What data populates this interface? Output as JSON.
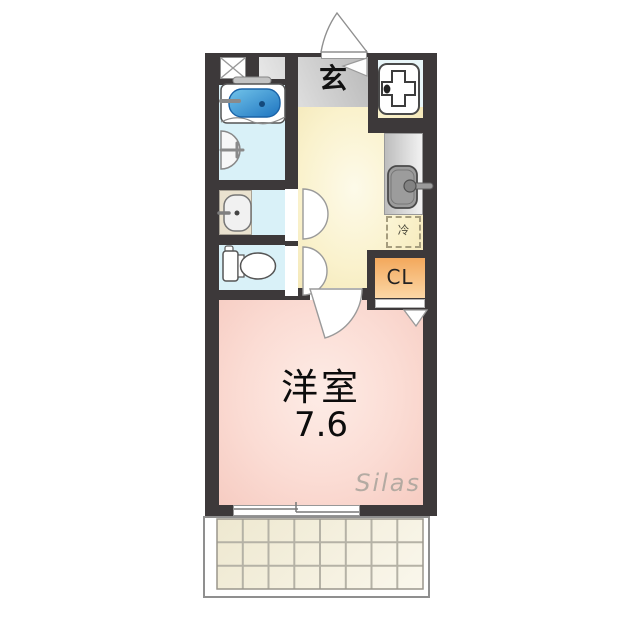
{
  "title": "apartment floor plan (1K unit)",
  "labels": {
    "entrance": "玄",
    "refrigerator": "冷",
    "closet": "CL",
    "room": "洋室",
    "room_size": "7.6",
    "watermark": "Silas"
  },
  "rooms": [
    {
      "name": "entrance-genkan",
      "label": "玄",
      "floor": "gray"
    },
    {
      "name": "bathroom",
      "fixtures": [
        "bathtub",
        "wall-washbasin"
      ],
      "floor": "light-blue"
    },
    {
      "name": "washroom",
      "fixtures": [
        "vanity-washbasin"
      ],
      "floor": "light-blue"
    },
    {
      "name": "toilet-room",
      "fixtures": [
        "toilet"
      ],
      "floor": "light-blue"
    },
    {
      "name": "kitchen-hallway",
      "fixtures": [
        "kitchen-counter-sink",
        "refrigerator-space",
        "washing-machine-pan"
      ],
      "floor": "pale-yellow"
    },
    {
      "name": "western-room",
      "label": "洋室",
      "size_tatami": "7.6",
      "floor": "pink"
    },
    {
      "name": "closet",
      "label": "CL"
    },
    {
      "name": "balcony",
      "grid_cols": 8,
      "grid_rows": 3
    },
    {
      "name": "pipe-space",
      "symbol": "crossed-box"
    }
  ],
  "doors": [
    "entrance-swing-door",
    "washroom-door",
    "toilet-door",
    "room-swing-door",
    "closet-door",
    "sliding-window-to-balcony"
  ],
  "colors": {
    "wall": "#3d393a",
    "entrance_floor": "#d9d9d9",
    "wet_room_floor": "#d9f1f8",
    "kitchen_floor": "#faf2cd",
    "vanity_counter": "#eae2cf",
    "kitchen_counter": "#d4d4d4",
    "closet": "#f5ad60",
    "main_room_floor": "#fbdcd4",
    "balcony_tile": "#f4efde",
    "bathtub_water": "#2e86cc"
  }
}
